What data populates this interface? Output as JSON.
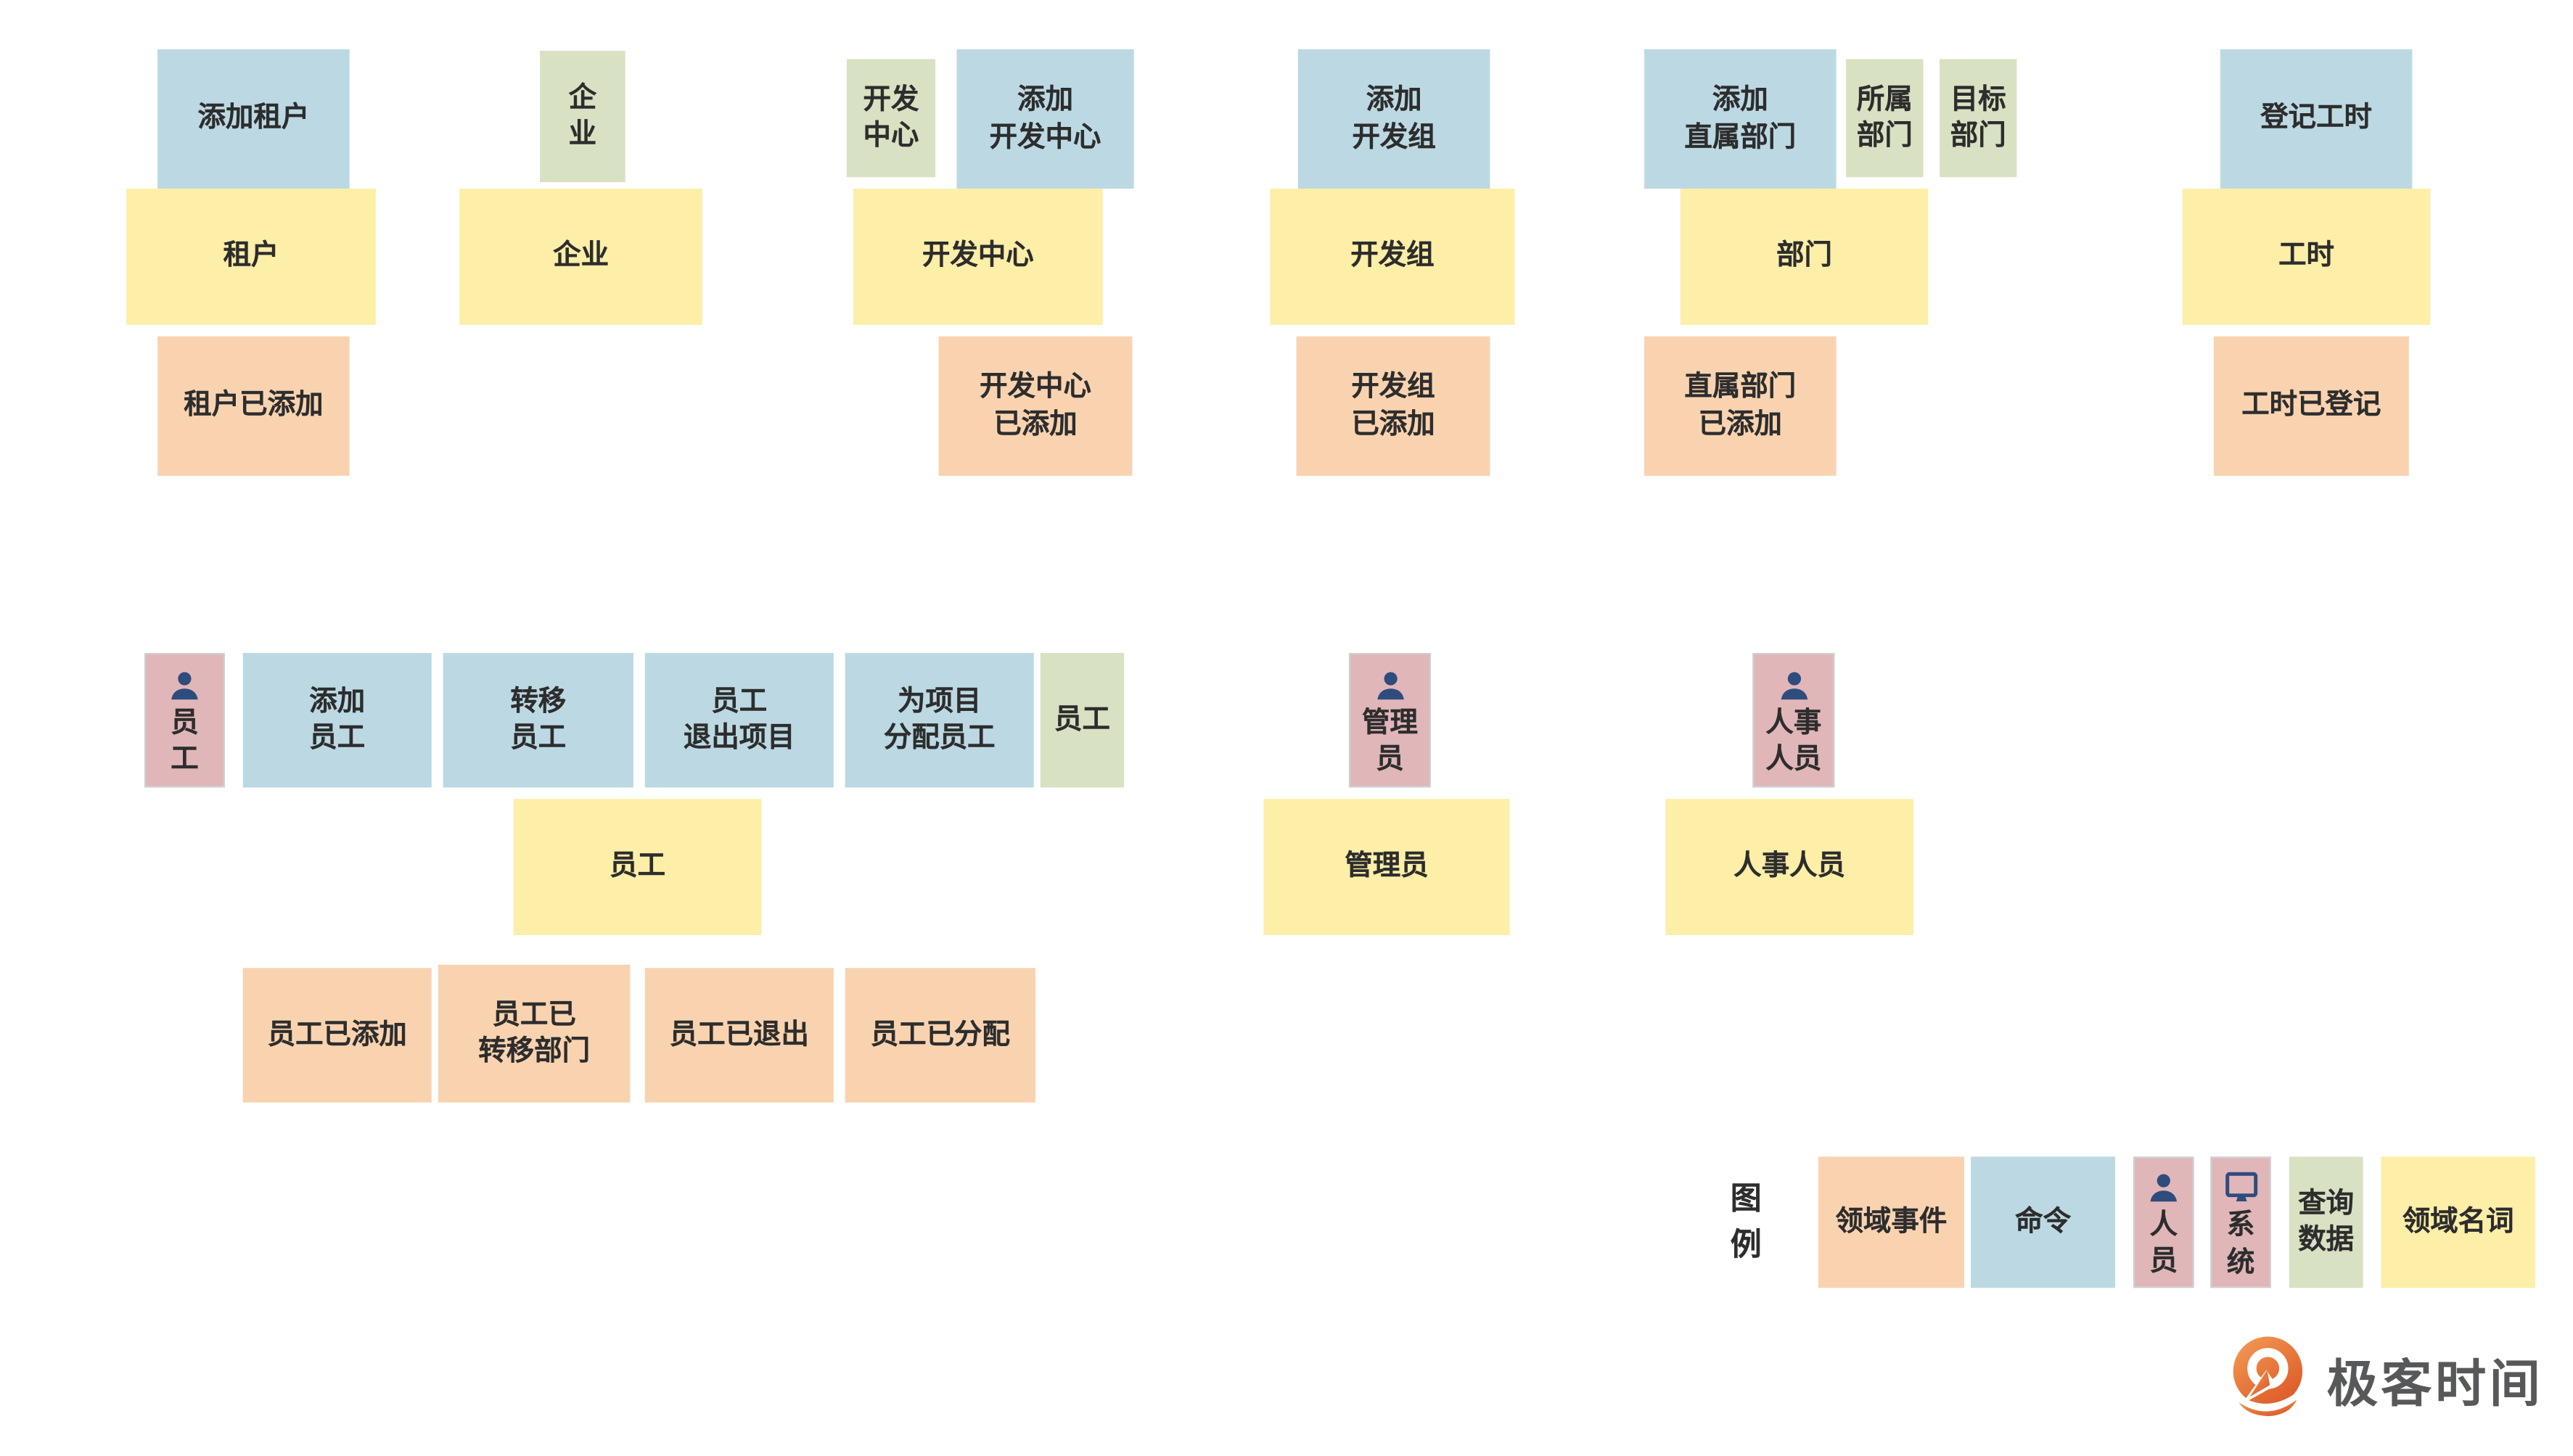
{
  "palette": {
    "command_blue": "#bcd9e3",
    "noun_yellow": "#fdeea8",
    "event_orange": "#f9d3b0",
    "query_green": "#d8e1c2",
    "actor_pink": "#e0b6b9",
    "icon_navy": "#2e4c7c",
    "text_dark": "#2d2d2d",
    "logo_orange": "#e8732f",
    "logo_text_gray": "#57585a"
  },
  "groups": {
    "tenant": {
      "command": "添加租户",
      "noun": "租户",
      "event": "租户已添加"
    },
    "enterprise": {
      "query": "企\n业",
      "noun": "企业"
    },
    "dev_center": {
      "query": "开发\n中心",
      "command": "添加\n开发中心",
      "noun": "开发中心",
      "event": "开发中心\n已添加"
    },
    "dev_team": {
      "command": "添加\n开发组",
      "noun": "开发组",
      "event": "开发组\n已添加"
    },
    "department": {
      "command": "添加\n直属部门",
      "owner_dept": "所属\n部门",
      "target_dept": "目标\n部门",
      "noun": "部门",
      "event": "直属部门\n已添加"
    },
    "work_hours": {
      "command": "登记工时",
      "noun": "工时",
      "event": "工时已登记"
    },
    "employee": {
      "actor": "员\n工",
      "command_add": "添加\n员工",
      "command_transfer": "转移\n员工",
      "command_quit_project": "员工\n退出项目",
      "command_assign_project": "为项目\n分配员工",
      "query": "员工",
      "noun": "员工",
      "event_added": "员工已添加",
      "event_transferred": "员工已\n转移部门",
      "event_quit": "员工已退出",
      "event_assigned": "员工已分配"
    },
    "admin": {
      "actor": "管理\n员",
      "noun": "管理员"
    },
    "hr": {
      "actor": "人事\n人员",
      "noun": "人事人员"
    }
  },
  "legend": {
    "title": "图\n例",
    "items": [
      {
        "kind": "event",
        "label": "领域事件"
      },
      {
        "kind": "command",
        "label": "命令"
      },
      {
        "kind": "person",
        "label": "人\n员",
        "icon": "person-icon"
      },
      {
        "kind": "system",
        "label": "系\n统",
        "icon": "monitor-icon"
      },
      {
        "kind": "query",
        "label": "查询\n数据"
      },
      {
        "kind": "noun",
        "label": "领域名词"
      }
    ]
  },
  "logo": {
    "name": "极客时间"
  }
}
